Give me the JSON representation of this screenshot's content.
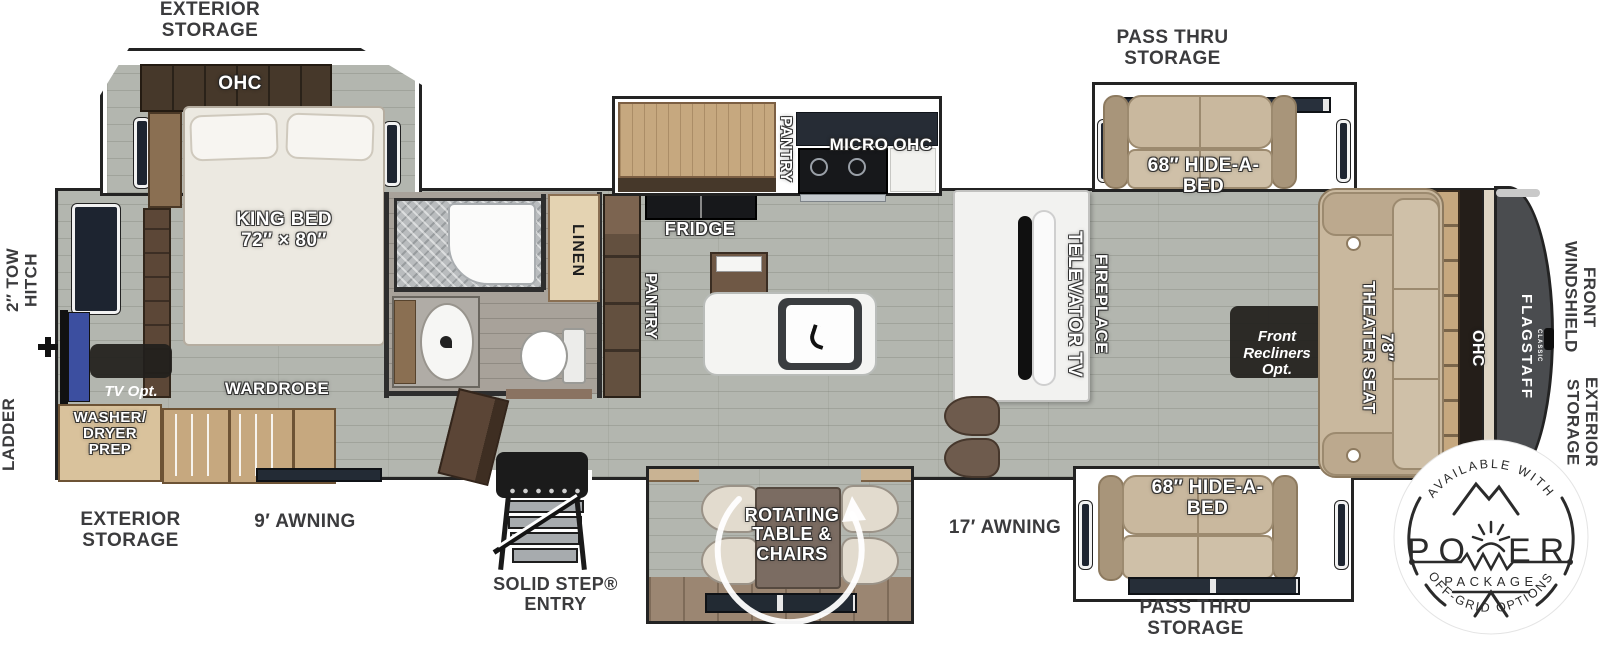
{
  "colors": {
    "floor": "#b3b6af",
    "wall": "#232323",
    "cap": "#4a4c4f",
    "sofa": "#c9b89e",
    "wood_light": "#c6a87f",
    "wood_mid": "#8a6f52",
    "wood_dark": "#46382a",
    "tv_blue": "#3c4fa0",
    "table": "#7b6c62",
    "label": "#3b3b3d",
    "ink": "#2b2b2b"
  },
  "brand": {
    "name": "FLAGSTAFF",
    "series": "CLASSIC"
  },
  "exterior_labels": {
    "storage_top": "EXTERIOR\nSTORAGE",
    "storage_bottom_left": "EXTERIOR\nSTORAGE",
    "pass_thru_top": "PASS THRU\nSTORAGE",
    "pass_thru_bottom": "PASS THRU\nSTORAGE",
    "tow_hitch": "2″ TOW\nHITCH",
    "ladder": "LADDER",
    "awning_rear": "9′ AWNING",
    "awning_main": "17′ AWNING",
    "entry": "SOLID STEP®\nENTRY",
    "front_windshield": "FRONT\nWINDSHIELD",
    "storage_front_right": "EXTERIOR\nSTORAGE"
  },
  "bedroom": {
    "ohc": "OHC",
    "king_bed": "KING BED\n72″ × 80″",
    "wardrobe": "WARDROBE",
    "washer_dryer": "WASHER/\nDRYER\nPREP",
    "tv_opt": "TV Opt."
  },
  "bathroom": {
    "linen": "LINEN"
  },
  "kitchen": {
    "pantry_slide": "PANTRY",
    "micro_ohc": "MICRO OHC",
    "fridge": "FRIDGE",
    "pantry": "PANTRY"
  },
  "living": {
    "televator_tv": "TELEVATOR TV",
    "fireplace": "FIREPLACE",
    "hide_a_bed_top": "68″ HIDE-A-\nBED",
    "hide_a_bed_bottom": "68″ HIDE-A-\nBED",
    "theater_seat": "78″\nTHEATER SEAT",
    "front_recliners": "Front\nRecliners\nOpt.",
    "ohc_front": "OHC",
    "dinette": "ROTATING\nTABLE &\nCHAIRS"
  },
  "badge": {
    "top": "AVAILABLE WITH",
    "power_left": "PO",
    "power_right": "ER",
    "package": "PACKAGE",
    "bottom": "OFF-GRID OPTIONS"
  }
}
